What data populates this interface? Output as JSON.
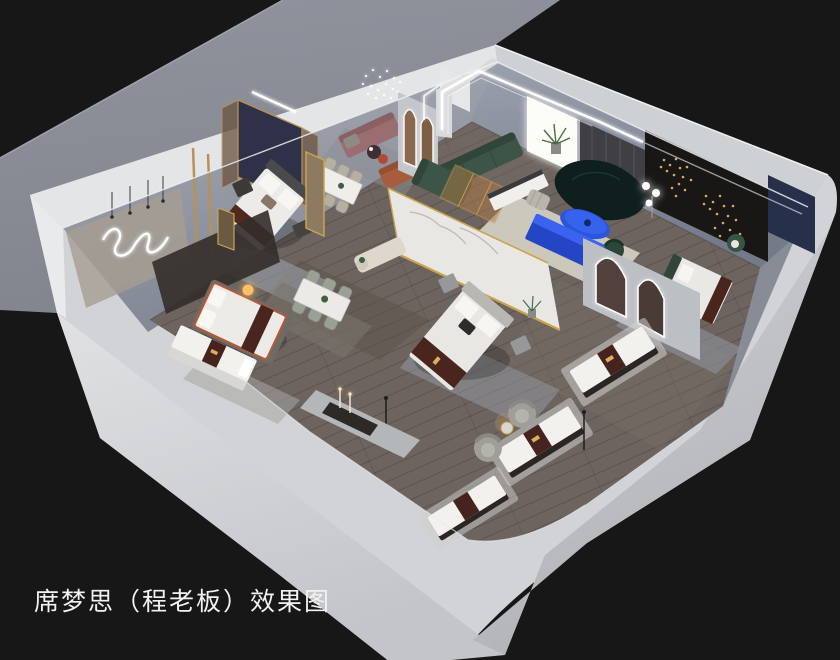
{
  "scene": {
    "caption": "席梦思（程老板）效果图",
    "type_label": "isometric cutaway rendering of a Simmons mattress showroom",
    "palette": {
      "background": "#171717",
      "ground": "#8e919b",
      "wall_top": "#d2d3d6",
      "wall_face_light": "#dfe0e2",
      "wall_face_dark": "#b7b9bd",
      "interior_wall": "#9aa0ac",
      "floor": "#6d645f",
      "gold": "#c9a44e",
      "marble": "#e9e7e4",
      "brand_runner": "#4a251e",
      "mattress_white": "#f2f1ee",
      "sofa_green": "#3d5546",
      "sofa_teal": "#0e1f1d",
      "accent_blue": "#2c55dd",
      "terracotta": "#a65c3d",
      "mauve": "#9a6e70",
      "navy_panel": "#2e3148",
      "rug_cream": "#ded9cd",
      "led_white": "#ffffff",
      "lamp_warm": "#ffc067"
    },
    "rooms": [
      {
        "id": "bedroom-left",
        "label": "left bedroom display"
      },
      {
        "id": "lounge",
        "label": "lounge display"
      },
      {
        "id": "living-room",
        "label": "living room display"
      },
      {
        "id": "bedroom-center",
        "label": "center bedroom display"
      },
      {
        "id": "bedroom-right",
        "label": "right bedroom display"
      },
      {
        "id": "dining",
        "label": "dining displays"
      },
      {
        "id": "mattress-gallery",
        "label": "mattress display gallery"
      }
    ],
    "furniture_icons": [
      "bed-icon",
      "mattress-icon",
      "dining-table-icon",
      "chair-icon",
      "sofa-icon",
      "curved-sofa-icon",
      "coffee-table-icon",
      "media-console-icon",
      "arch-mirror-icon",
      "marble-partition-icon",
      "plant-icon",
      "floor-lamp-icon",
      "chandelier-icon",
      "led-arch-icon",
      "neon-squiggle-icon",
      "barrel-chair-icon",
      "nightstand-icon"
    ]
  }
}
